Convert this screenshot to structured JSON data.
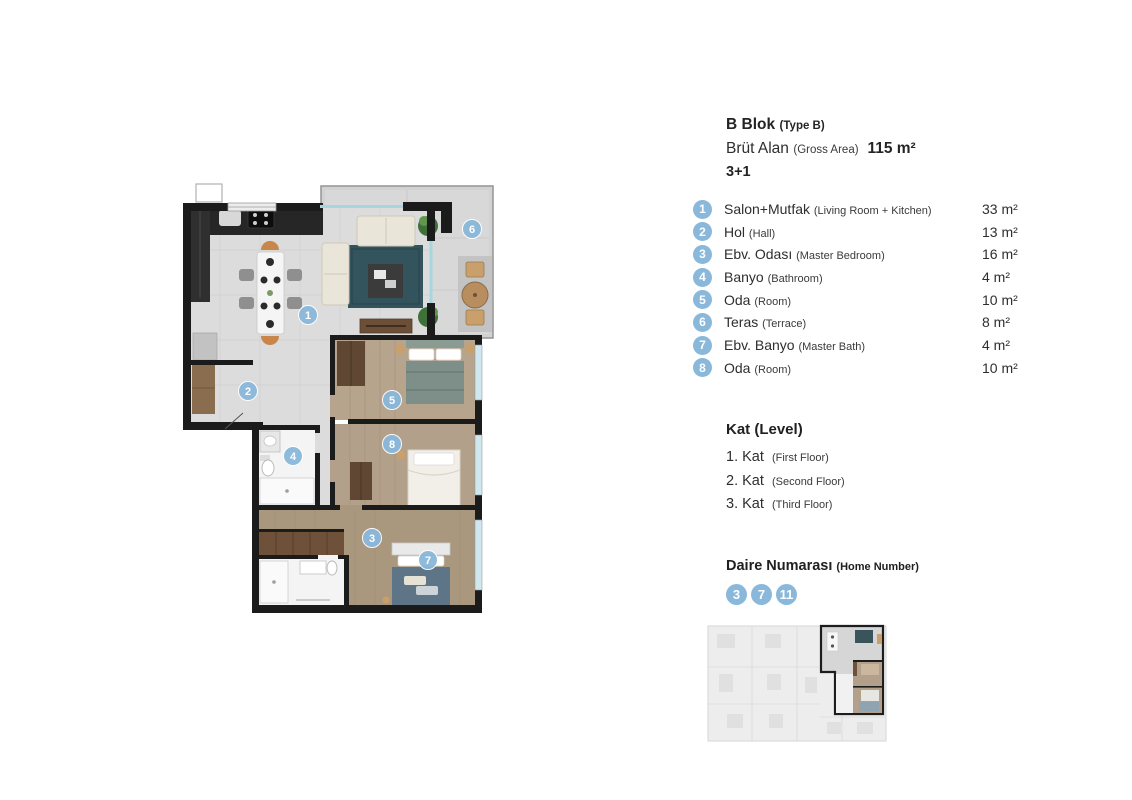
{
  "header": {
    "block": "B Blok",
    "block_note": "(Type B)",
    "gross_label": "Brüt Alan",
    "gross_note": "(Gross Area)",
    "gross_value": "115 m²",
    "layout": "3+1"
  },
  "rooms": [
    {
      "num": "1",
      "name": "Salon+Mutfak",
      "note": "(Living Room + Kitchen)",
      "area": "33 m²"
    },
    {
      "num": "2",
      "name": "Hol",
      "note": "(Hall)",
      "area": "13 m²"
    },
    {
      "num": "3",
      "name": "Ebv. Odası",
      "note": "(Master Bedroom)",
      "area": "16 m²"
    },
    {
      "num": "4",
      "name": "Banyo",
      "note": "(Bathroom)",
      "area": "4 m²"
    },
    {
      "num": "5",
      "name": "Oda",
      "note": "(Room)",
      "area": "10 m²"
    },
    {
      "num": "6",
      "name": "Teras",
      "note": "(Terrace)",
      "area": "8 m²"
    },
    {
      "num": "7",
      "name": "Ebv. Banyo",
      "note": "(Master Bath)",
      "area": "4 m²"
    },
    {
      "num": "8",
      "name": "Oda",
      "note": "(Room)",
      "area": "10 m²"
    }
  ],
  "levels": {
    "title": "Kat (Level)",
    "items": [
      {
        "name": "1. Kat",
        "note": "(First Floor)"
      },
      {
        "name": "2. Kat",
        "note": "(Second Floor)"
      },
      {
        "name": "3. Kat",
        "note": "(Third Floor)"
      }
    ]
  },
  "homes": {
    "title": "Daire Numarası",
    "note": "(Home Number)",
    "numbers": [
      "3",
      "7",
      "11"
    ]
  },
  "plan": {
    "badges": [
      "1",
      "2",
      "3",
      "4",
      "5",
      "6",
      "7",
      "8"
    ]
  },
  "colors": {
    "badge_blue": "#8ab8da",
    "wall_black": "#1b1b1b",
    "floor_gray": "#dcdcdc",
    "floor_wood": "#b3a08a",
    "rug_teal": "#33545c"
  }
}
